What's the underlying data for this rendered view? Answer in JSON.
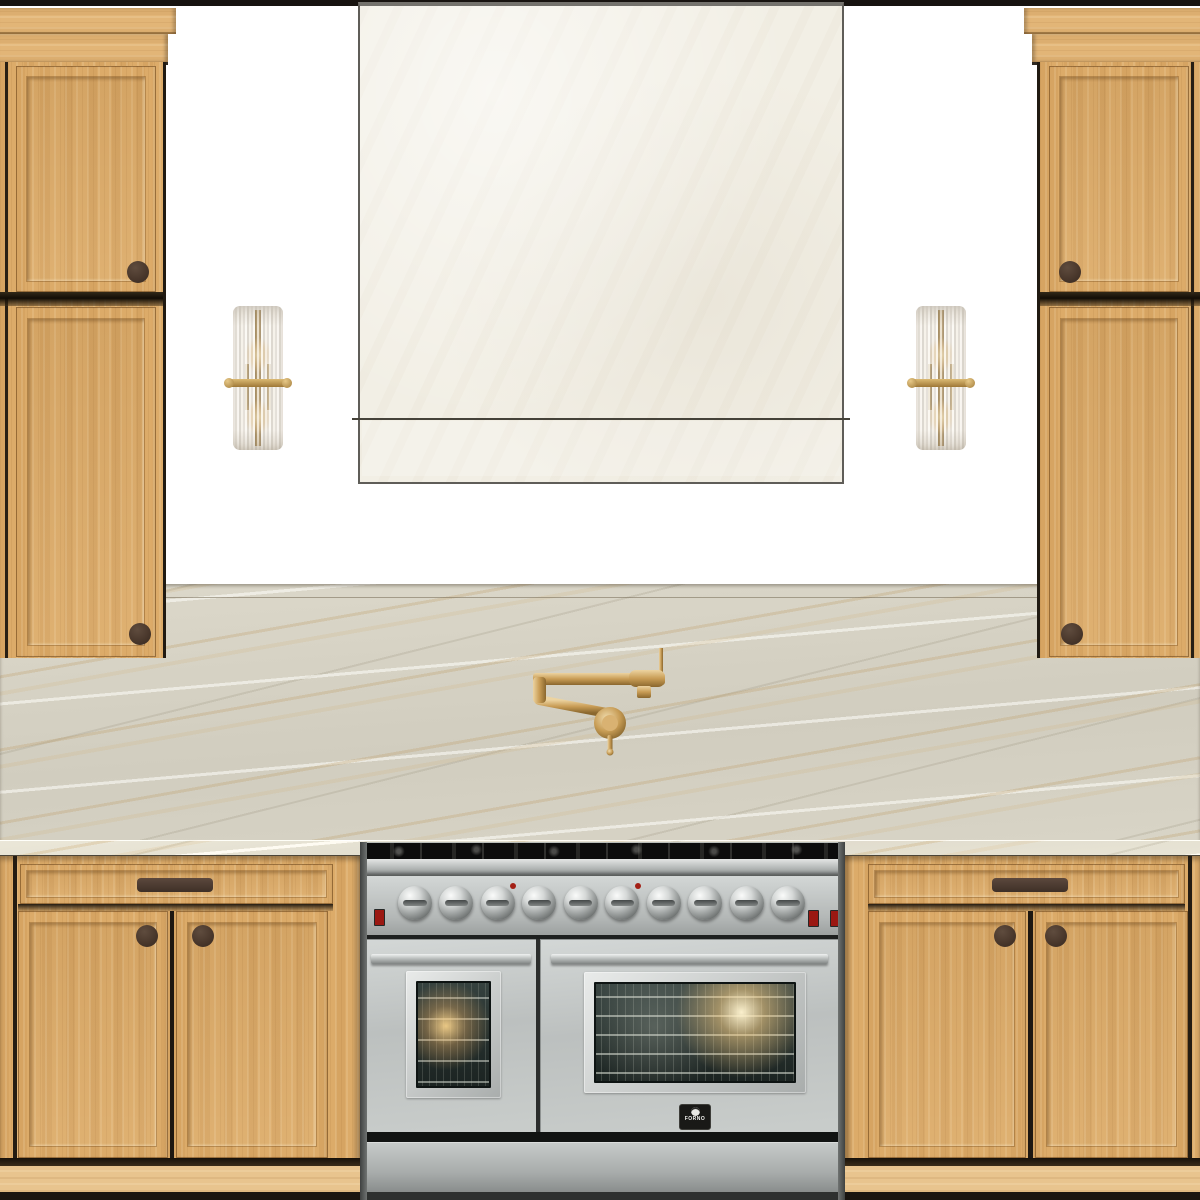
{
  "scene": {
    "type": "kitchen elevation design board",
    "wall_color": "#ffffff",
    "ceiling_line_color": "#171310"
  },
  "palette": {
    "cabinet_wood": "#dcab69",
    "crown_wood": "#e2b577",
    "toe_kick_wood": "#e8c48e",
    "cabinet_hardware": "#4a382c",
    "marble_base": "#d8d4c6",
    "marble_vein": "#c3a87d",
    "hood_plaster": "#f2efe5",
    "brass": "#c89c55",
    "stainless": "#c4c8c7",
    "oven_glass": "#273230"
  },
  "range": {
    "brand": "FORNO",
    "finish": "stainless steel",
    "burner_knob_count": 10,
    "oven_count": 2,
    "indicator_light_count": 2,
    "power_switch_count": 3
  },
  "cabinetry": {
    "finish": "white oak",
    "tall_cabinet_count": 2,
    "tall_cabinet_doors_each": 2,
    "base_cabinet_count": 2,
    "base_drawer_count": 2,
    "base_doors_each": 2,
    "knob_shape": "round",
    "drawer_pull_shape": "bar"
  },
  "lighting": {
    "sconce_count": 2,
    "sconce_style": "fluted glass cylinder with brass bracket",
    "bulbs_per_sconce": 2
  },
  "fixtures": {
    "pot_filler_finish": "brass",
    "pot_filler_type": "wall mount articulating"
  },
  "surfaces": {
    "backsplash": "full-height marble slab",
    "hood": "plaster box hood with reveal line"
  }
}
